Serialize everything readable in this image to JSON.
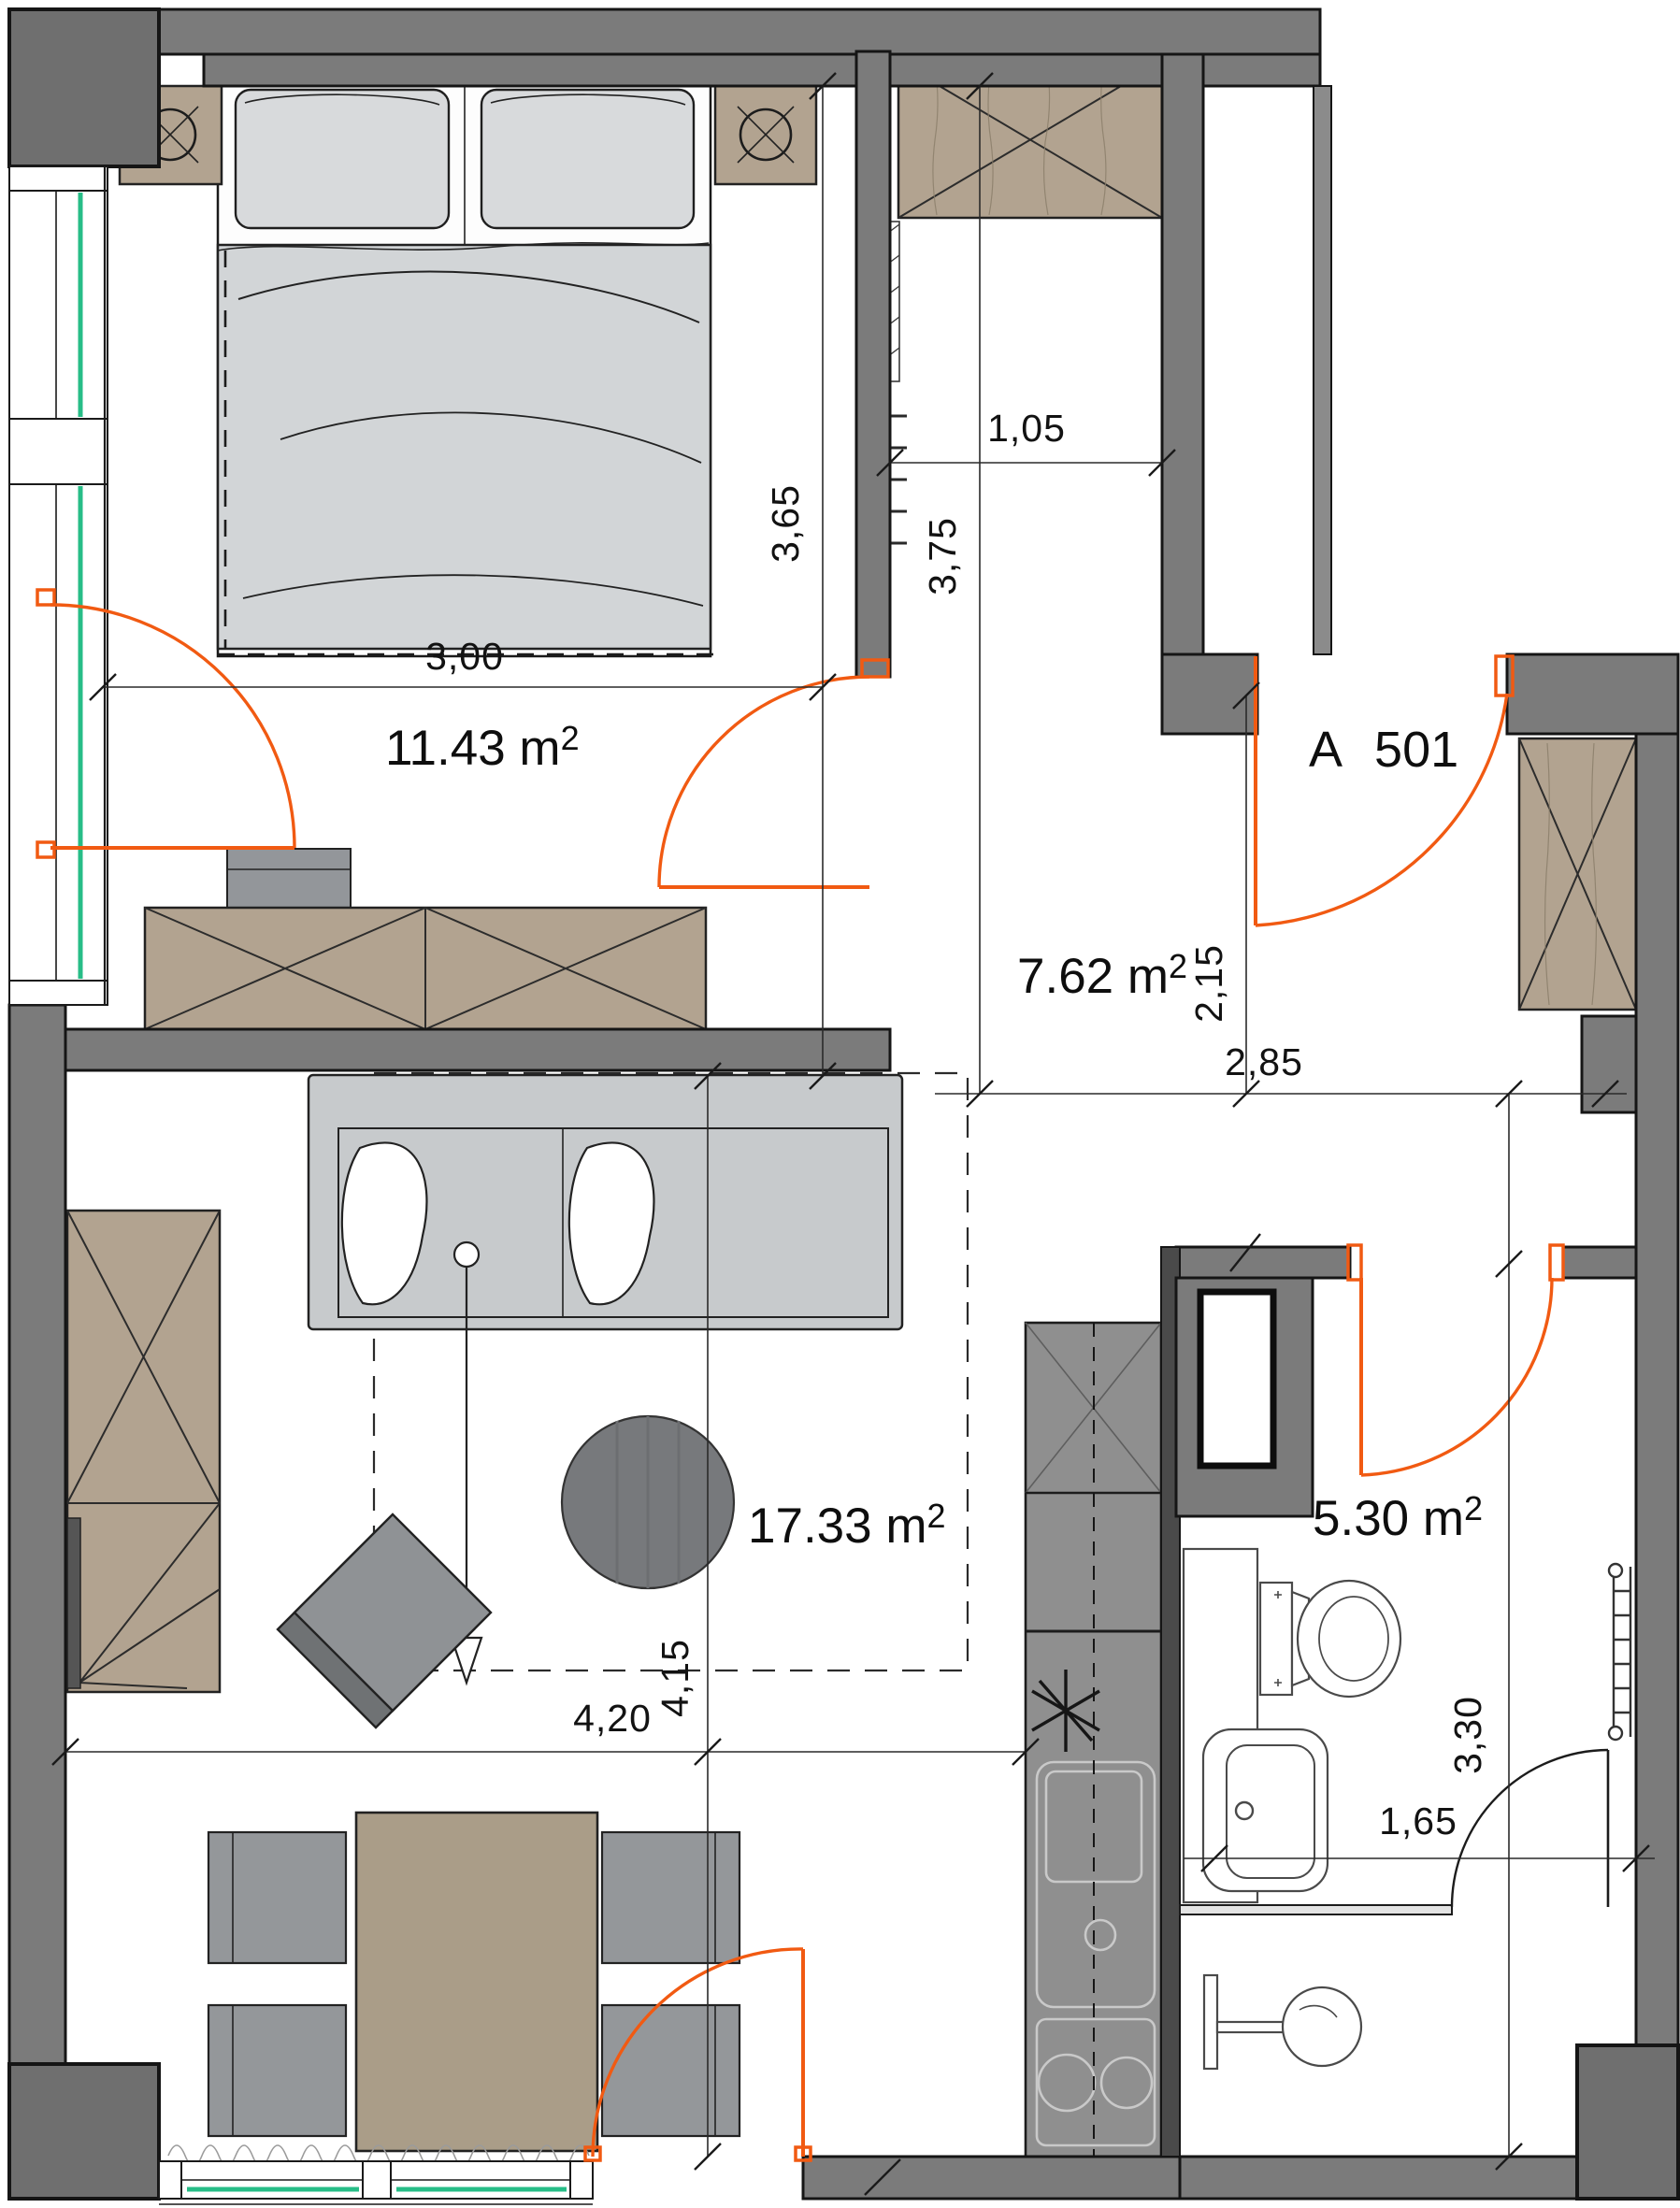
{
  "plan": {
    "apartment_label": "A 501",
    "rooms": {
      "bedroom": {
        "area": "11.43 m",
        "sup": "2"
      },
      "hall": {
        "area": "7.62 m",
        "sup": "2"
      },
      "living": {
        "area": "17.33 m",
        "sup": "2"
      },
      "bathroom": {
        "area": "5.30 m",
        "sup": "2"
      }
    },
    "dimensions": {
      "bed_width": "3,00",
      "bedroom_depth": "3,65",
      "hall_depth": "3,75",
      "wardrobe_width": "1,05",
      "entry_depth": "2,15",
      "hall_width": "2,85",
      "living_width": "4,20",
      "living_depth": "4,15",
      "bathroom_depth": "3,30",
      "bathroom_width": "1,65"
    },
    "colors": {
      "wall": "#7b7b7b",
      "door_accent": "#f15a12",
      "glazing": "#27bd87",
      "wood": "#b2a390"
    }
  }
}
